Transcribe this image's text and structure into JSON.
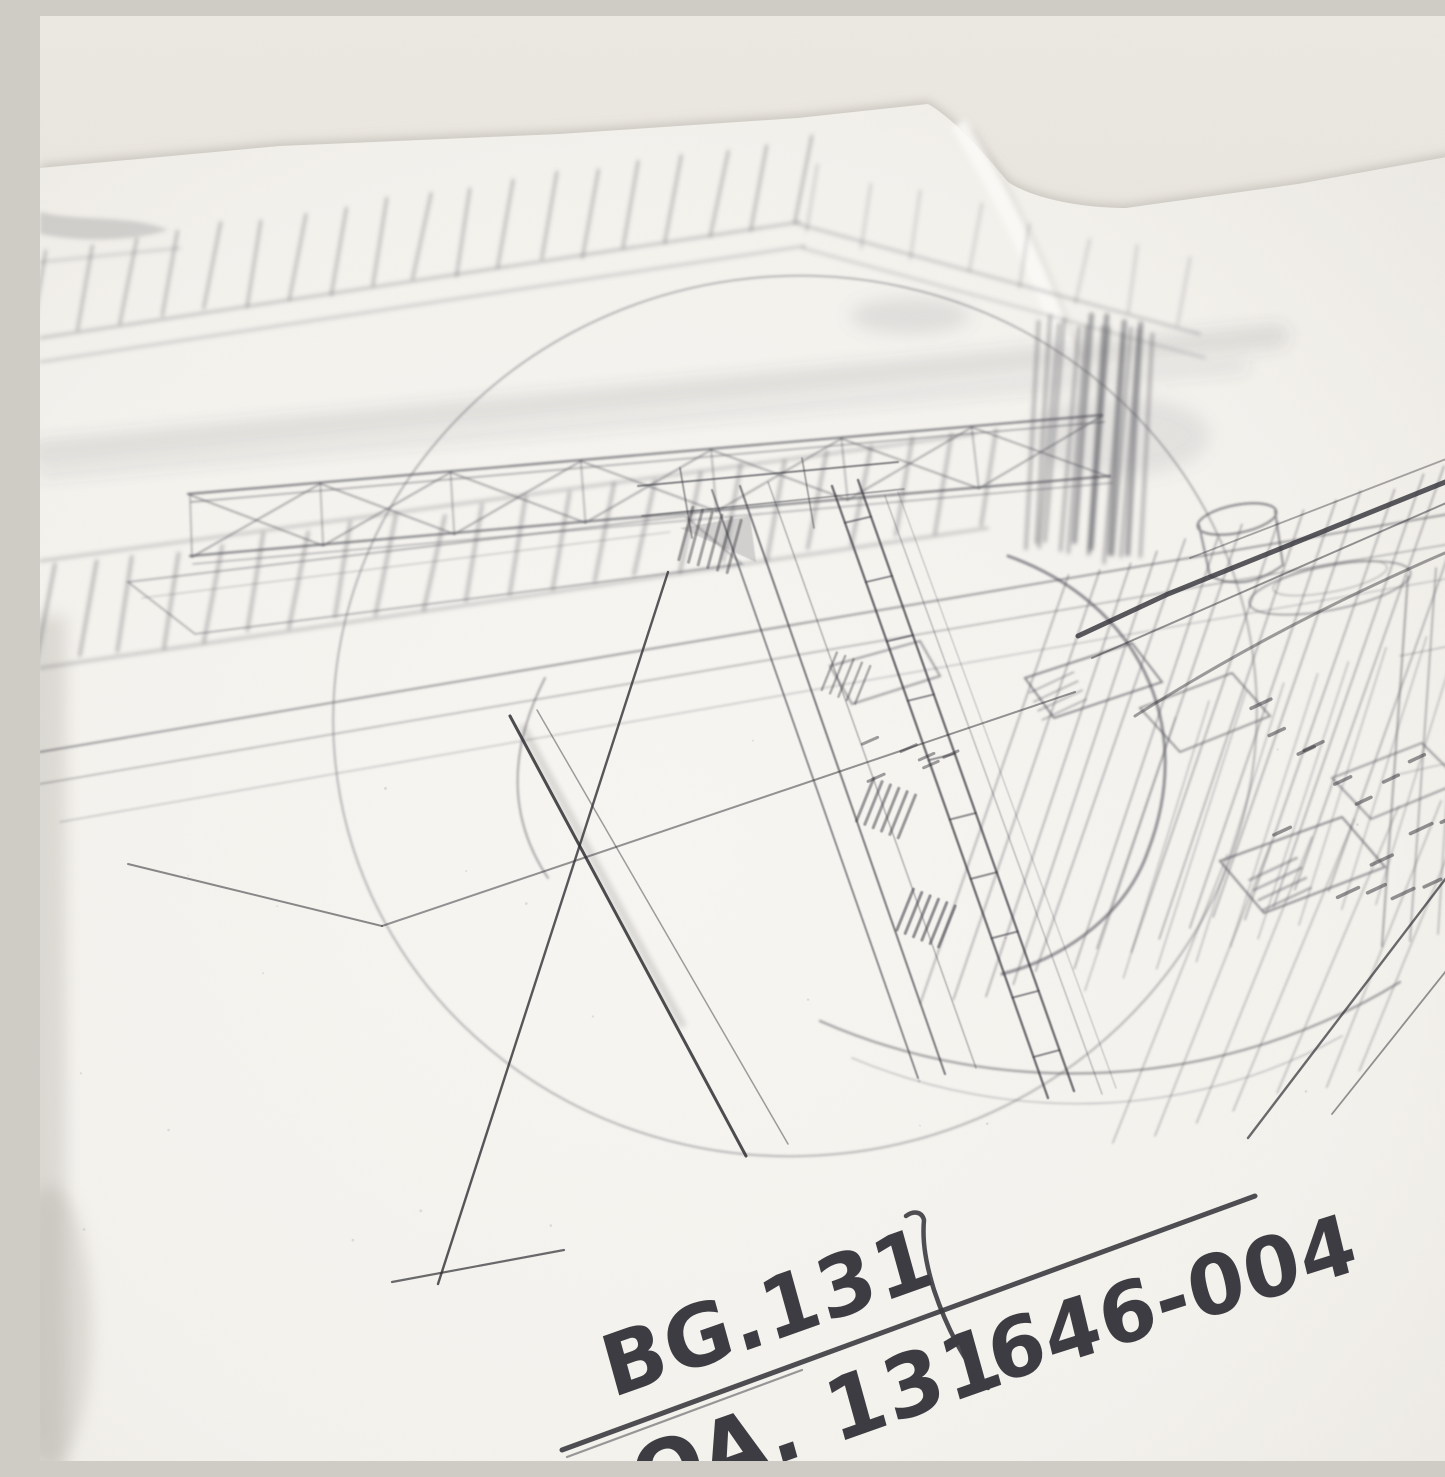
{
  "scene": {
    "type": "photograph",
    "subject": "close-up of a pencil production layout sketch on white paper, viewed at an angle",
    "paper_color": "#f6f4f0",
    "backdrop_color": "#e5e1db",
    "pencil_color": "#3a3a40",
    "graphite_smudge_color": "#8d8d94"
  },
  "annotations": {
    "bg_number": "BG.131",
    "scene_number": "646-004",
    "second_line": "OA. 131",
    "second_line_partially_visible": true
  }
}
